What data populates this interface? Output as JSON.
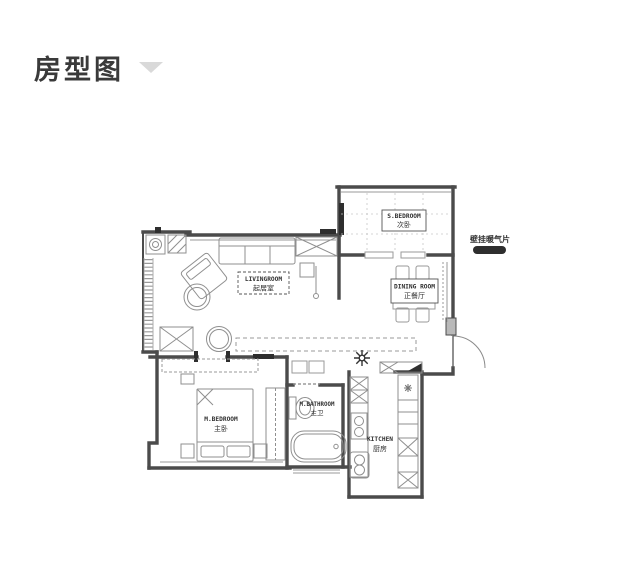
{
  "page": {
    "title": "房型图"
  },
  "header": {
    "collapse_icon": "chevron-down-icon"
  },
  "plan": {
    "annotation": {
      "text": "壁挂暖气片"
    },
    "rooms": {
      "s_bedroom": {
        "en": "S.BEDROOM",
        "zh": "次卧"
      },
      "living": {
        "en": "LIVINGROOM",
        "zh": "起居室"
      },
      "dining": {
        "en": "DINING ROOM",
        "zh": "正餐厅"
      },
      "m_bedroom": {
        "en": "M.BEDROOM",
        "zh": "主卧"
      },
      "m_bathroom": {
        "en": "M.BATHROOM",
        "zh": "主卫"
      },
      "kitchen": {
        "en": "KITCHEN",
        "zh": "厨房"
      }
    },
    "colors": {
      "wall": "#4b4b4b",
      "furniture": "#8f8f8f",
      "accent_dark": "#2e2e2e"
    }
  }
}
